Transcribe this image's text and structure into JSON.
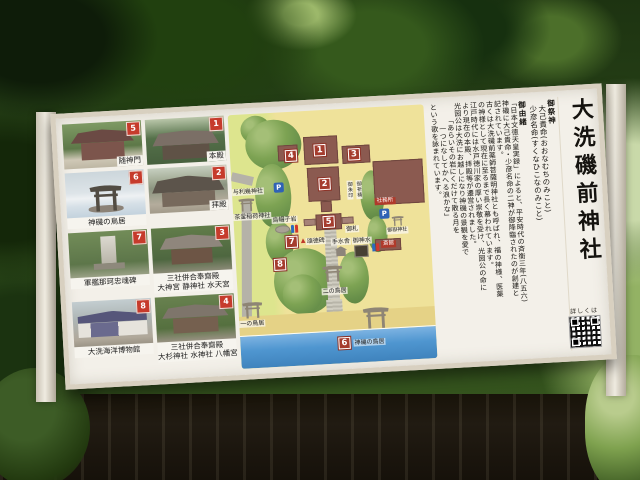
{
  "board": {
    "photos": [
      {
        "num": "5",
        "caption": "随神門"
      },
      {
        "num": "1",
        "caption": "本殿"
      },
      {
        "num": "6",
        "caption": "神磯の鳥居"
      },
      {
        "num": "2",
        "caption": "拝殿"
      },
      {
        "num": "7",
        "caption": "軍艦那珂忠魂碑"
      },
      {
        "num": "3",
        "caption": "三社併合奉齋殿",
        "sub": "大神宮 静神社 水天宮"
      },
      {
        "num": "8",
        "caption": "大洗海洋博物館"
      },
      {
        "num": "4",
        "caption": "三社併合奉齋殿",
        "sub": "大杉神社 水神社 八幡宮"
      }
    ],
    "map": {
      "markers": [
        "1",
        "2",
        "3",
        "4",
        "5",
        "6",
        "7",
        "8"
      ],
      "labels": {
        "yoriki_jinja": "与利幾神社",
        "chagama_inari": "茶釜稲荷神社",
        "eboshi_iwa": "烏帽子岩",
        "shotokuhi": "頌徳碑",
        "triangle": "▲",
        "ichino_torii": "一の鳥居",
        "nino_torii": "二の鳥居",
        "kamiiso_no_torii": "神磯の鳥居",
        "chozuya": "手水舎",
        "goshinsui": "御神水",
        "shamusho": "社務所",
        "saikan": "斎館",
        "mitake_jinja": "御嶽神社",
        "goshuin": "御朱印",
        "gokito": "御祈祷",
        "ofuda": "御札",
        "parking": "P"
      },
      "colors": {
        "ground": "#efe29a",
        "trees": "#7da353",
        "building": "#8b5a50",
        "sea": "#4f96d0",
        "marker_red": "#a53c2e"
      }
    },
    "info_panel": {
      "title": "大洗磯前神社",
      "deity_header": "御祭神",
      "deities": [
        "大己貴命(おおなむちのみこと)",
        "少彦名命(すくなひこなのみこと)"
      ],
      "history_header": "御由緒",
      "history_lines": [
        "「日本文徳天皇実録」によると、平安時代の斉衡三年(八五六)",
        "神磯に大己貴命・少彦名命の二神が御降臨されたのが創建と",
        "記されています。",
        "古くは大洗磯前薬師菩薩明神社とも呼ばれ、福の神様、医薬",
        "の神様として現在に至るまで長く慕われています。",
        "江戸時代には水戸徳川家の厚い崇敬を受け、光圀公の命に",
        "より現在の本殿、拝殿等が遷営されました。",
        "光圀公は大洗にお越しになり神磯の景観を愛で"
      ],
      "poem_lines": [
        "「あらいその岩にくだけて散る月を",
        "一つになしてかへる浪かな」"
      ],
      "closing": "という歌を詠まれています。",
      "qr_label": "詳しくは"
    }
  }
}
